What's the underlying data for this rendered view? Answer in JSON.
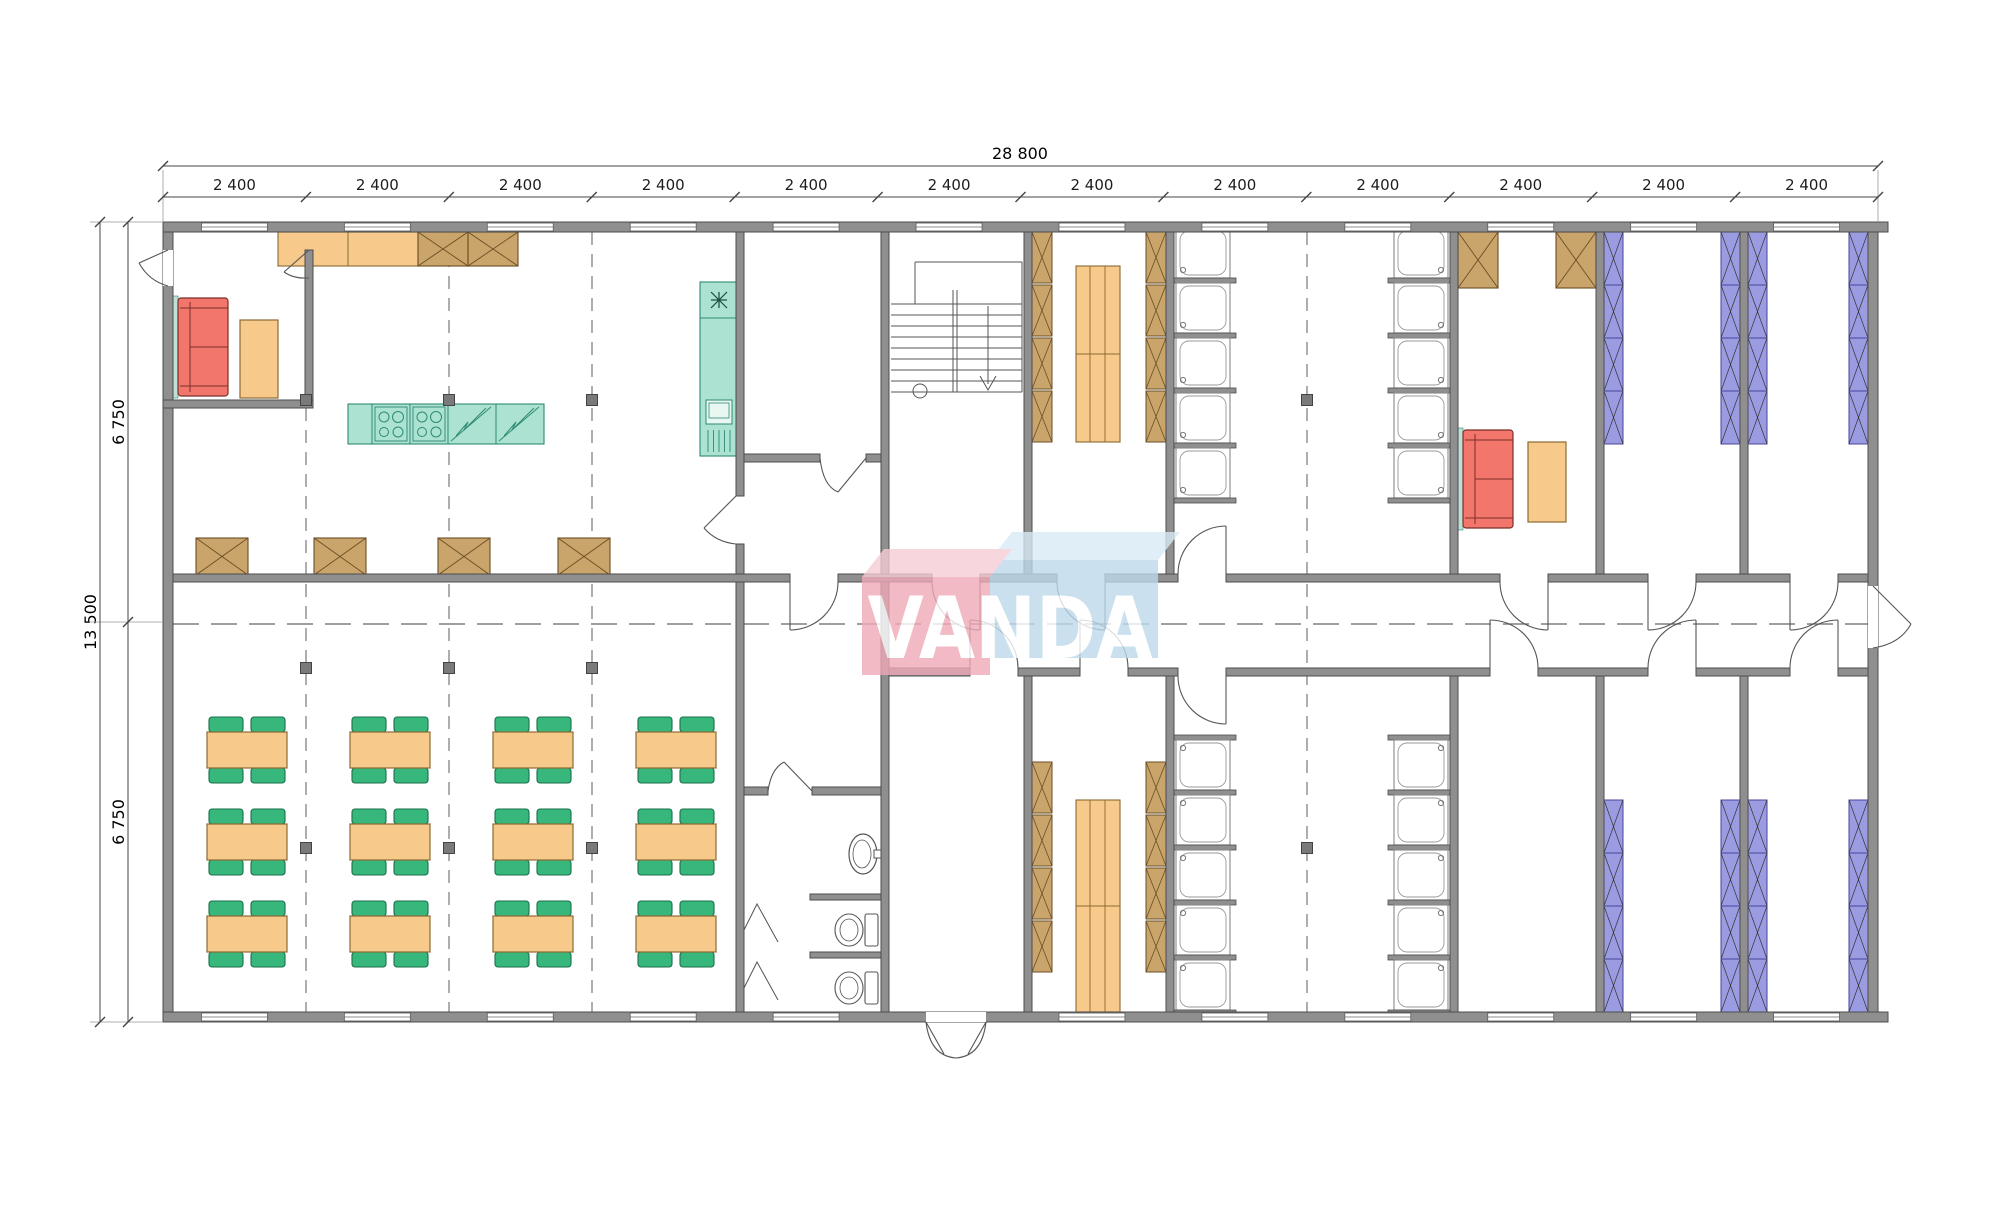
{
  "page": {
    "background": "#ffffff",
    "drawing_type": "floor-plan"
  },
  "watermark": {
    "text": "VANDA",
    "pink_top": "#f6ccd6",
    "pink_front": "#f0a9b6",
    "blue_top": "#d8eaf6",
    "blue_front": "#bdd9ec",
    "text_color": "#ffffff",
    "opacity": 0.8
  },
  "dimensions": {
    "overall_width_label": "28 800",
    "bay_labels": [
      "2 400",
      "2 400",
      "2 400",
      "2 400",
      "2 400",
      "2 400",
      "2 400",
      "2 400",
      "2 400",
      "2 400",
      "2 400",
      "2 400"
    ],
    "overall_depth_label": "13 500",
    "half_depth_labels": [
      "6 750",
      "6 750"
    ]
  },
  "colors": {
    "wall": "#8f8f8f",
    "wall_stroke": "#4d4d4d",
    "dim_line": "#444444",
    "dim_text": "#1d1d1d",
    "grid": "#777777",
    "marker": "#7a7a7a",
    "orange_fill": "#f7c98a",
    "orange_stroke": "#8a6a33",
    "wood_fill": "#c9a56b",
    "wood_stroke": "#6b4e24",
    "green_fill": "#38b77d",
    "green_stroke": "#177049",
    "teal_fill": "#abe2d1",
    "teal_stroke": "#2e8a74",
    "teal_wall": "#bfe0d8",
    "red_fill": "#f2766b",
    "red_stroke": "#7a2f28",
    "purple_fill": "#9b9be2",
    "purple_stroke": "#45459c",
    "fixture_stroke": "#555555",
    "door_stroke": "#555555",
    "window_fill": "#ffffff",
    "window_stroke": "#666666"
  },
  "plan": {
    "bay_count": 12,
    "dining_tables": {
      "col_centers": [
        247,
        390,
        533,
        676
      ],
      "row_centers": [
        750,
        842,
        934
      ],
      "chairs_per_table": 4
    },
    "kitchen": {
      "cooktop_burners": 4,
      "island_sections": 5
    },
    "showers": {
      "rows_top": [
        228,
        283,
        338,
        393,
        448
      ],
      "rows_bottom": [
        740,
        795,
        850,
        905,
        960
      ],
      "columns_x_left": 1176,
      "columns_x_right": 1394
    },
    "locker_cells_top": [
      232,
      285,
      338,
      391
    ],
    "locker_cells_bottom": [
      762,
      815,
      868,
      921
    ],
    "beds": {
      "xs": [
        1604,
        1721,
        1748,
        1849
      ],
      "top_y": 232,
      "bottom_y": 800,
      "cell_h": 53,
      "cells": 4
    },
    "wardrobe_boxes_top_left": [
      [
        418,
        232
      ],
      [
        468,
        232
      ]
    ],
    "wardrobe_boxes_lounge": [
      [
        1458,
        232
      ],
      [
        1556,
        232
      ]
    ],
    "x_tables_row": [
      196,
      314,
      438,
      558
    ],
    "column_markers": [
      [
        306,
        400
      ],
      [
        449,
        400
      ],
      [
        592,
        400
      ],
      [
        306,
        668
      ],
      [
        449,
        668
      ],
      [
        592,
        668
      ],
      [
        306,
        848
      ],
      [
        449,
        848
      ],
      [
        592,
        848
      ],
      [
        1307,
        400
      ],
      [
        1307,
        848
      ]
    ],
    "grid_vertical_x": [
      306,
      449,
      592,
      1307
    ],
    "toilets": 2,
    "washbasins": 1
  }
}
